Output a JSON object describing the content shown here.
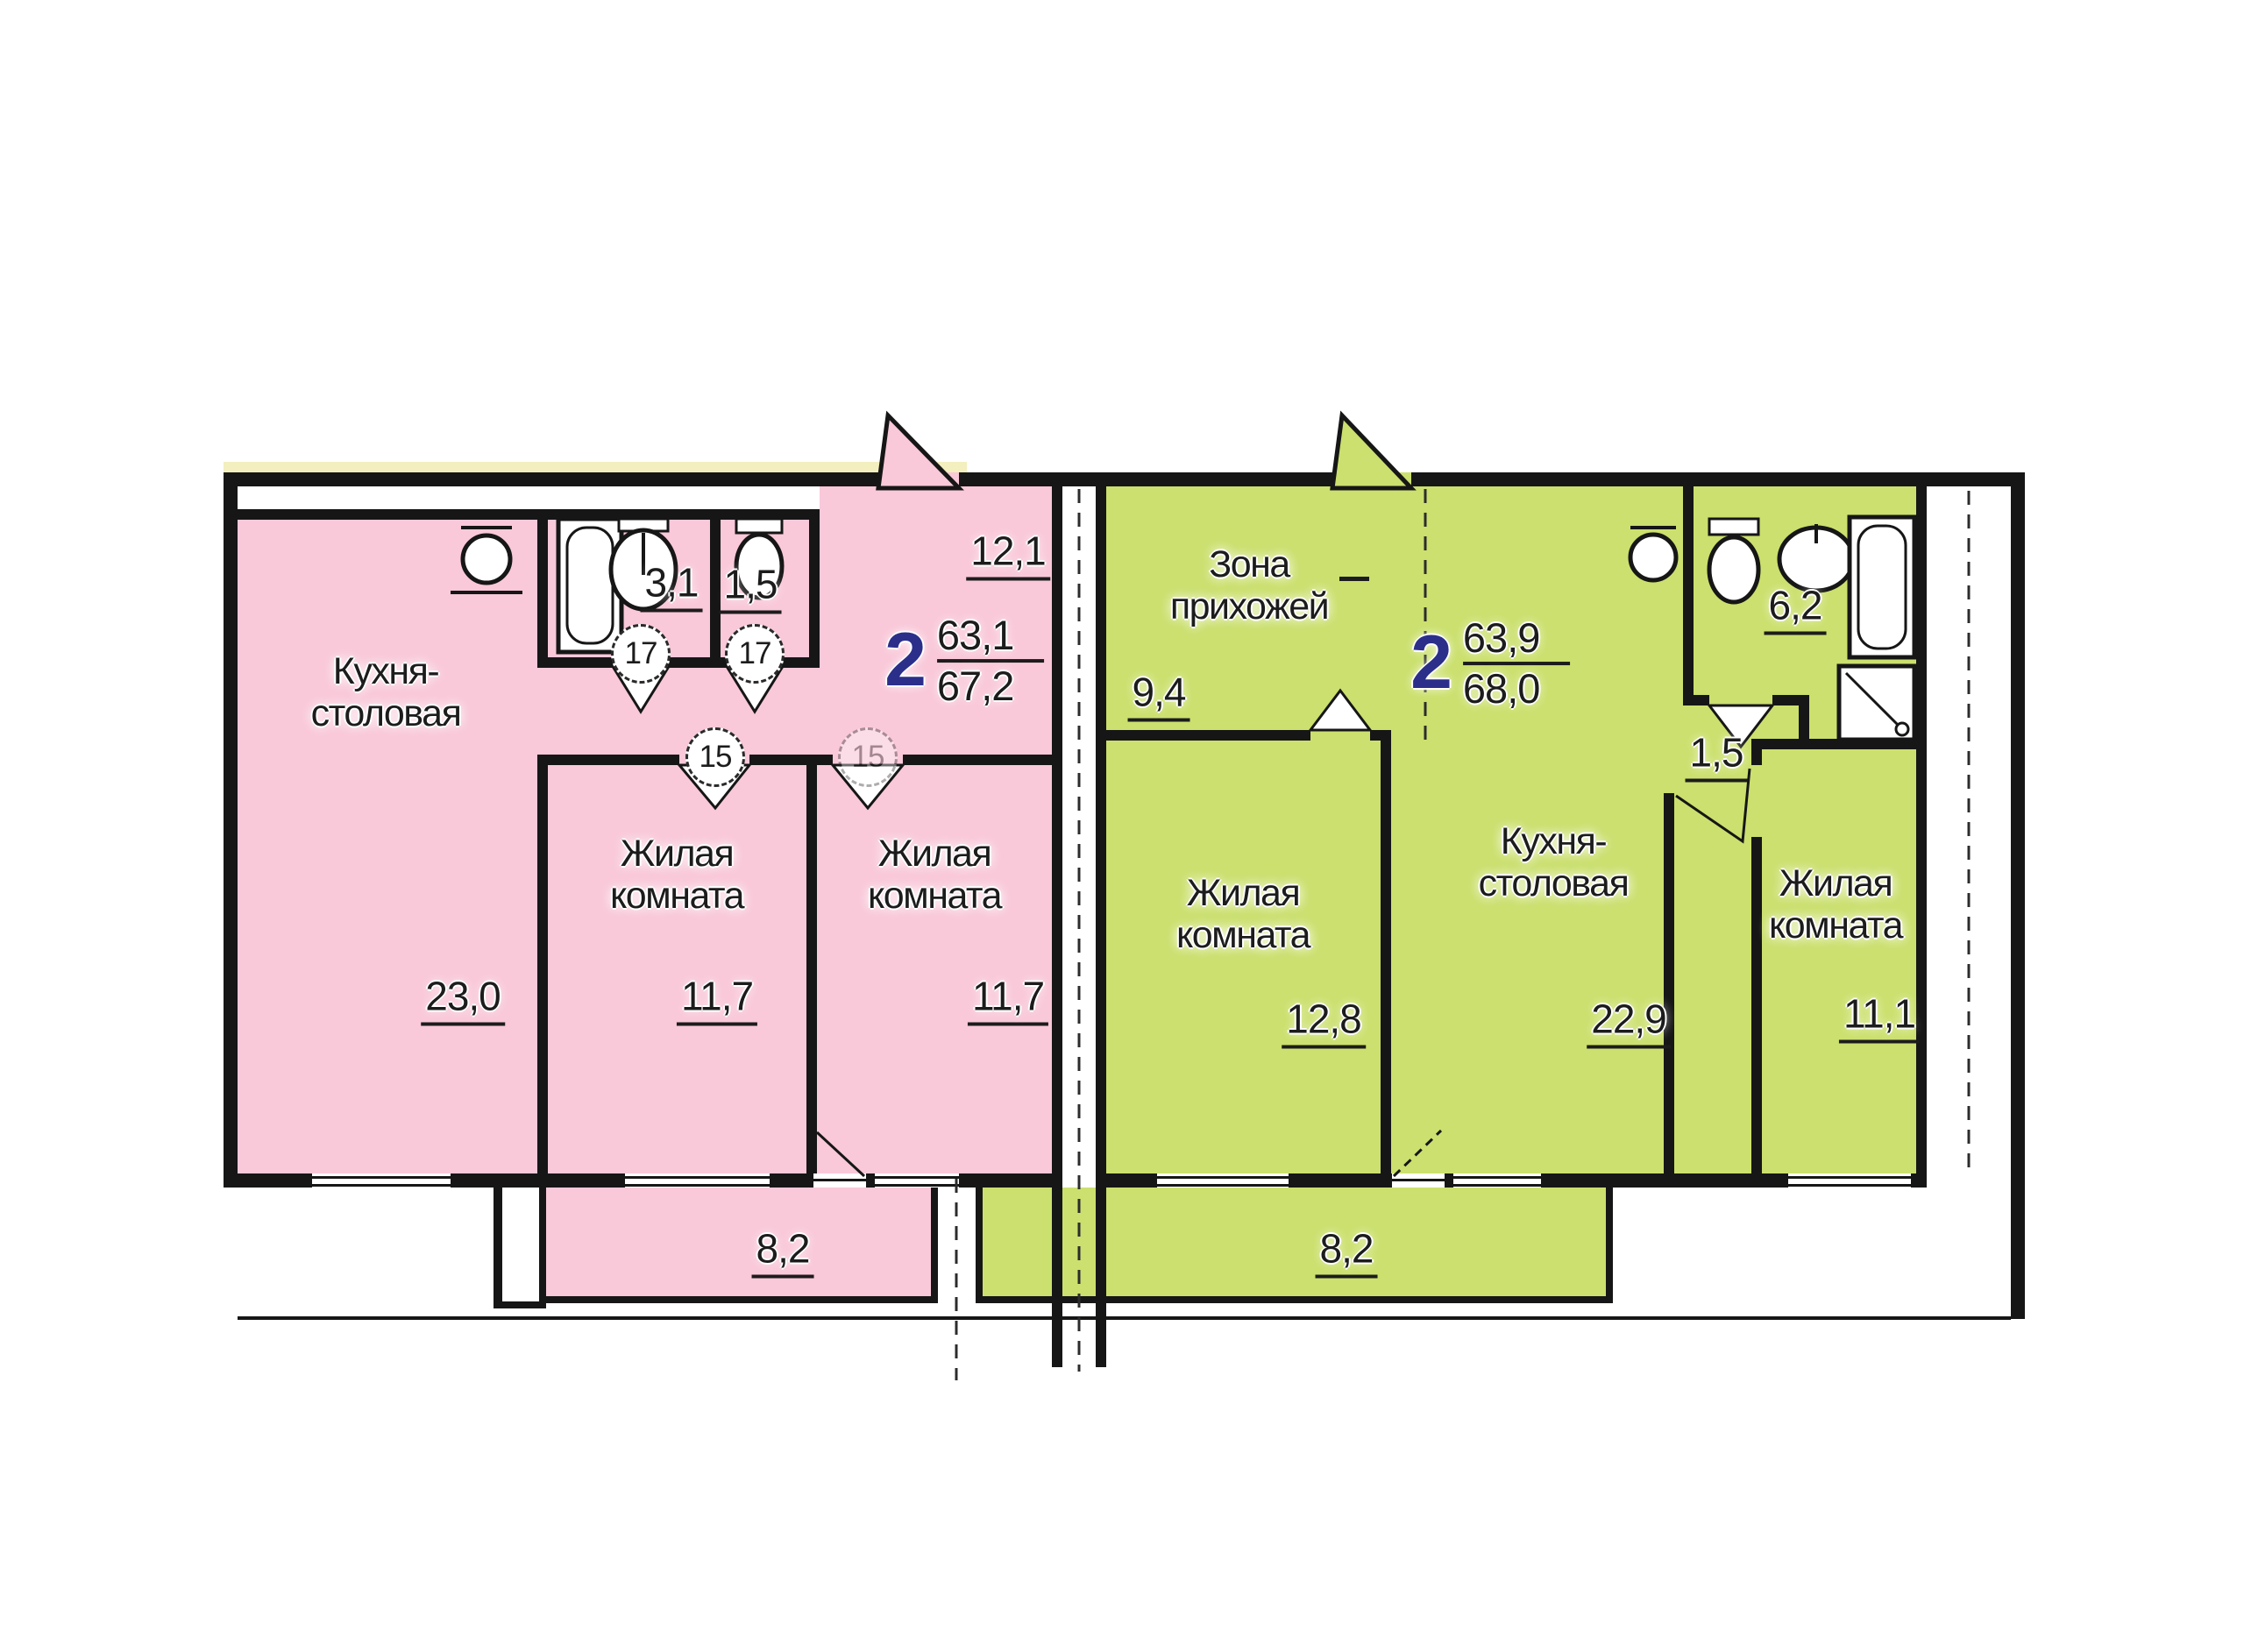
{
  "document": {
    "type": "apartment floor plan",
    "language": "ru"
  },
  "colors": {
    "left_apartment_fill": "#f9c8d9",
    "right_apartment_fill": "#cbe06e",
    "wall": "#161616",
    "unit_number_blue": "#2b2f8a",
    "accent_strip_yellow": "#f3efbe",
    "background": "#ffffff"
  },
  "left_apartment": {
    "unit": {
      "rooms": "2",
      "living_area": "63,1",
      "total_area": "67,2"
    },
    "kitchen": {
      "name_line1": "Кухня-",
      "name_line2": "столовая",
      "area": "23,0"
    },
    "bathroom": {
      "area": "3,1",
      "door_tag": "17"
    },
    "wc": {
      "area": "1,5",
      "door_tag": "17"
    },
    "hall": {
      "area": "12,1"
    },
    "bedroom_1": {
      "name_line1": "Жилая",
      "name_line2": "комната",
      "area": "11,7",
      "door_tag": "15"
    },
    "bedroom_2": {
      "name_line1": "Жилая",
      "name_line2": "комната",
      "area": "11,7",
      "door_tag": "15"
    },
    "balcony": {
      "area": "8,2"
    },
    "fixtures": [
      "bathtub",
      "wash-basin",
      "toilet",
      "kitchen-sink"
    ]
  },
  "right_apartment": {
    "unit": {
      "rooms": "2",
      "living_area": "63,9",
      "total_area": "68,0"
    },
    "hall_zone": {
      "name_line1": "Зона",
      "name_line2": "прихожей",
      "area": "9,4"
    },
    "bedroom_1": {
      "name_line1": "Жилая",
      "name_line2": "комната",
      "area": "12,8"
    },
    "kitchen": {
      "name_line1": "Кухня-",
      "name_line2": "столовая",
      "area": "22,9"
    },
    "bathroom": {
      "area": "6,2"
    },
    "corridor": {
      "area": "1,5"
    },
    "bedroom_2": {
      "name_line1": "Жилая",
      "name_line2": "комната",
      "area": "11,1"
    },
    "balcony": {
      "area": "8,2"
    },
    "fixtures": [
      "toilet",
      "wash-basin",
      "bathtub",
      "shower-tray",
      "kitchen-sink"
    ]
  }
}
